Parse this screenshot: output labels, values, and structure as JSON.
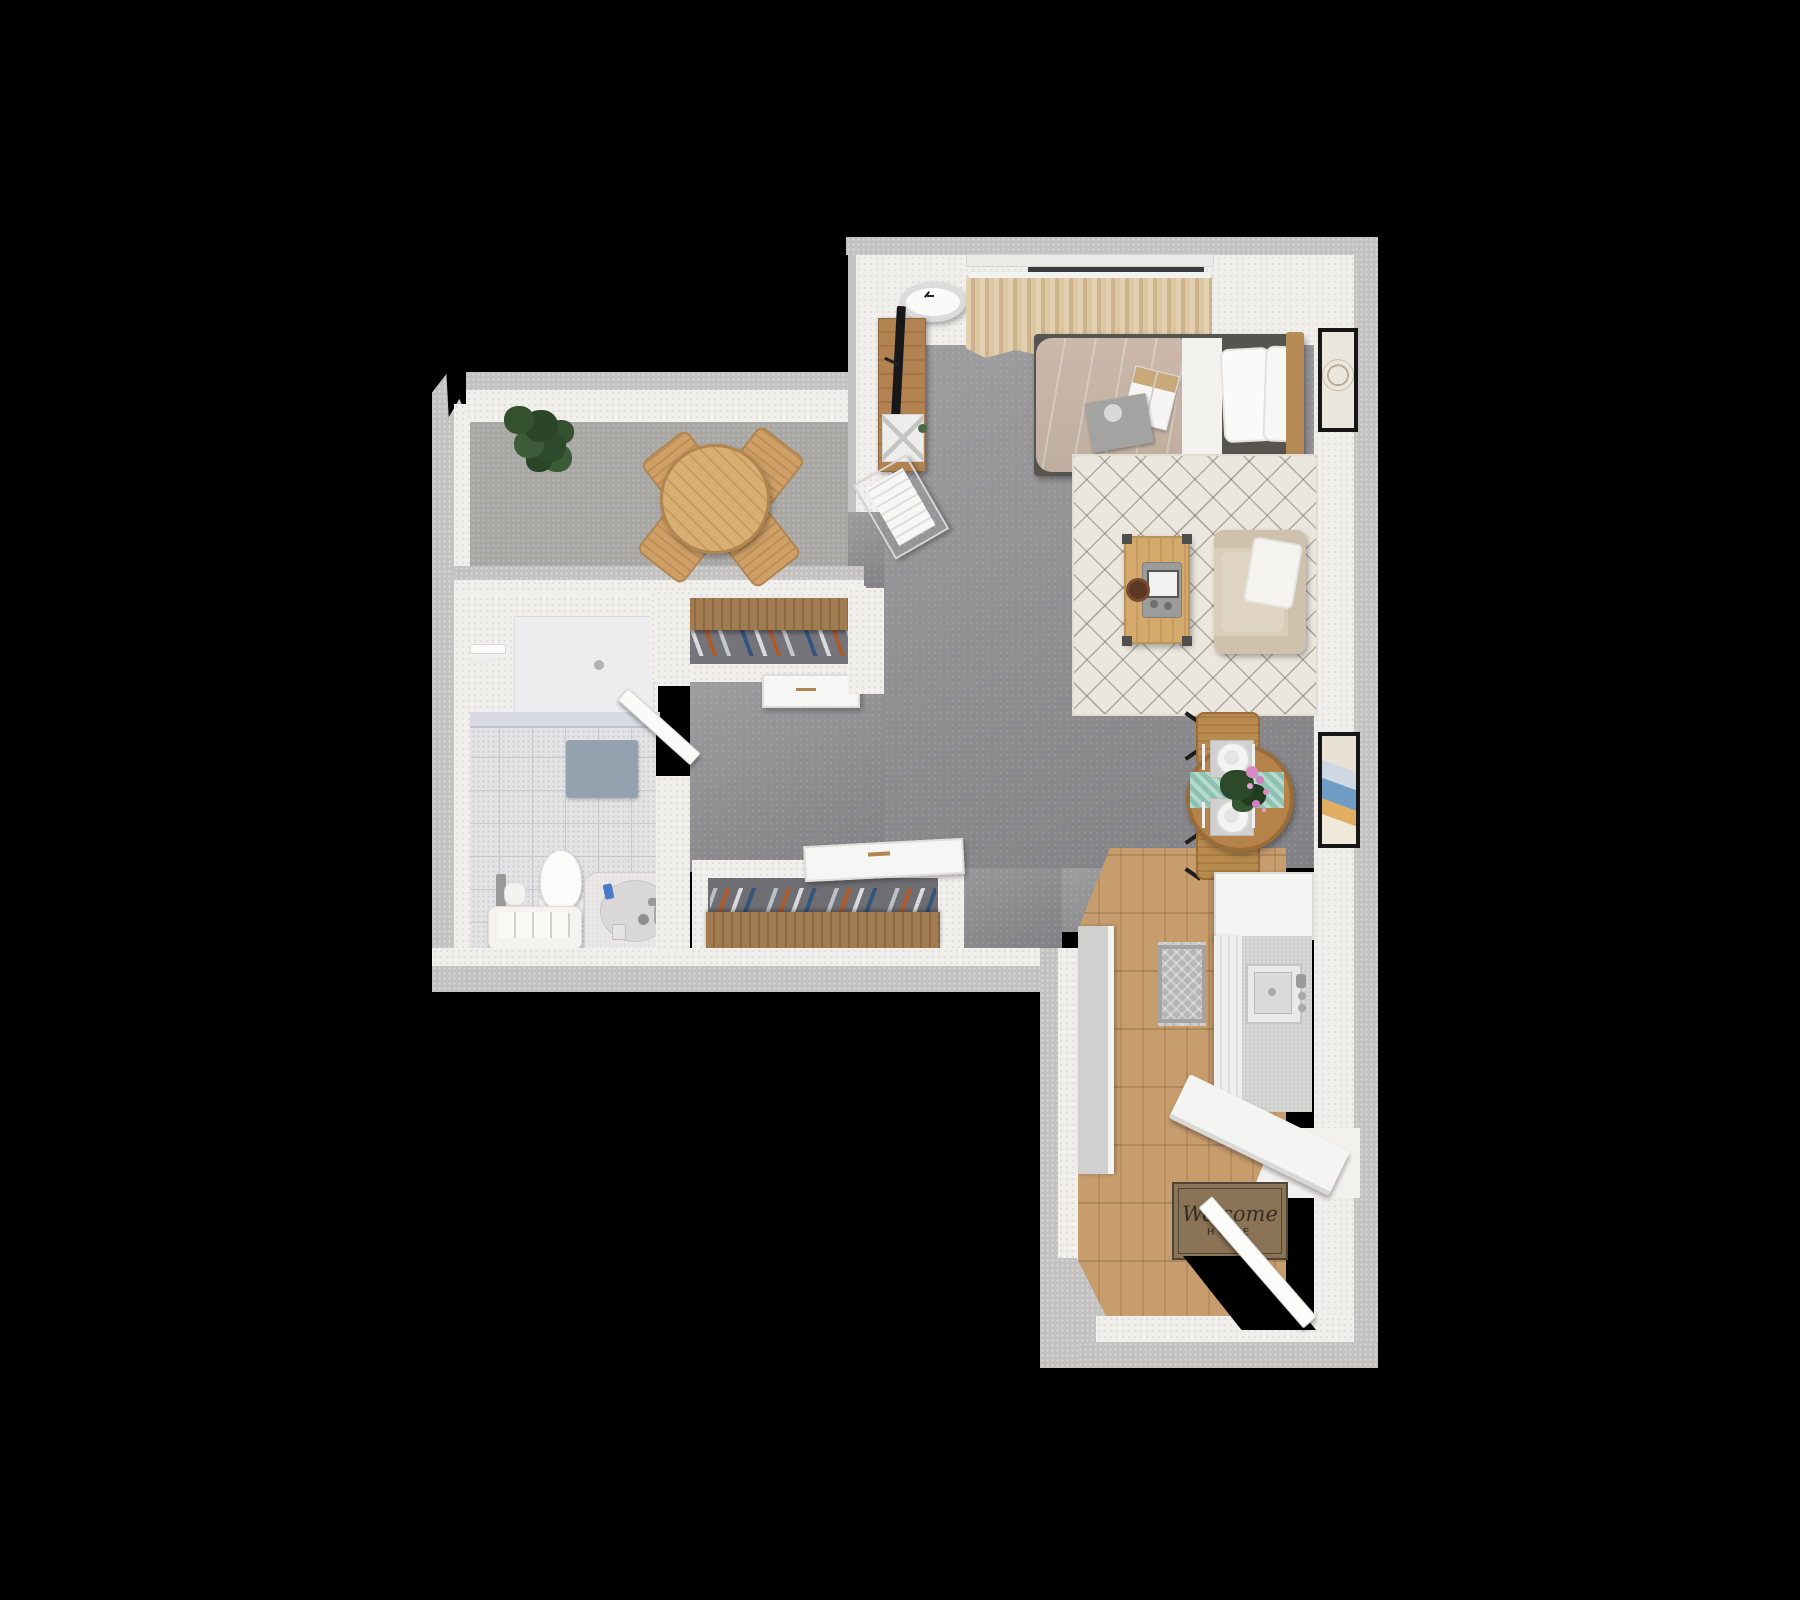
{
  "scene": {
    "type": "3d-floorplan-top-view",
    "description": "Rendered top-down 3D floor plan of a studio apartment on a black background",
    "background": "#000000"
  },
  "entry": {
    "mat_line1": "Welcome",
    "mat_line2": "HOME"
  },
  "rooms": [
    "dining room",
    "bathroom",
    "hallway with two closets",
    "bedroom / living area",
    "kitchen",
    "entry"
  ],
  "furniture": [
    "potted plant",
    "round dining table",
    "four slatted dining chairs",
    "wall clock",
    "tv console",
    "flat tv",
    "magazine rack",
    "radiator",
    "curtains with window",
    "bed with duvet and pillows",
    "magazines on bed",
    "wood headboard",
    "nightstand",
    "table lamp",
    "framed art bedroom",
    "area rug",
    "coffee table",
    "portable game console",
    "coaster",
    "armchair with pillow",
    "bistro table",
    "two bistro chairs",
    "teal table runner",
    "two place settings",
    "pink flowers",
    "framed art living",
    "shower",
    "shower glass ledge",
    "bath mat",
    "toilet",
    "toilet paper holder",
    "bath bench with towel",
    "bathtub",
    "closet shelf with hanging clothes",
    "second closet with hanging clothes",
    "white dresser",
    "white dresser angled",
    "kitchen island counter",
    "kitchen counter with sink",
    "refrigerator",
    "kitchen mat",
    "breakfast bar",
    "welcome door mat",
    "entry door",
    "bathroom door"
  ],
  "colors": {
    "background": "#000000",
    "wall_outer": "#c3c2c1",
    "wall_inner": "#f1efec",
    "floor_gray": "#8e8e91",
    "dining_carpet": "#a9a7a4",
    "bathroom_tile": "#e3e3e5",
    "wood_floor": "#c79d6e",
    "wood_furniture": "#c59960",
    "rug": "#ebe7de",
    "duvet": "#c6b3a5",
    "curtains": "#dcc7a5",
    "teal_runner": "#8cc3b0",
    "welcome_mat": "#8b7355",
    "plant": "#33512f",
    "bath_mat": "#93a2ae",
    "clothes_blue": "#33557e",
    "clothes_orange": "#ad5a2c"
  }
}
